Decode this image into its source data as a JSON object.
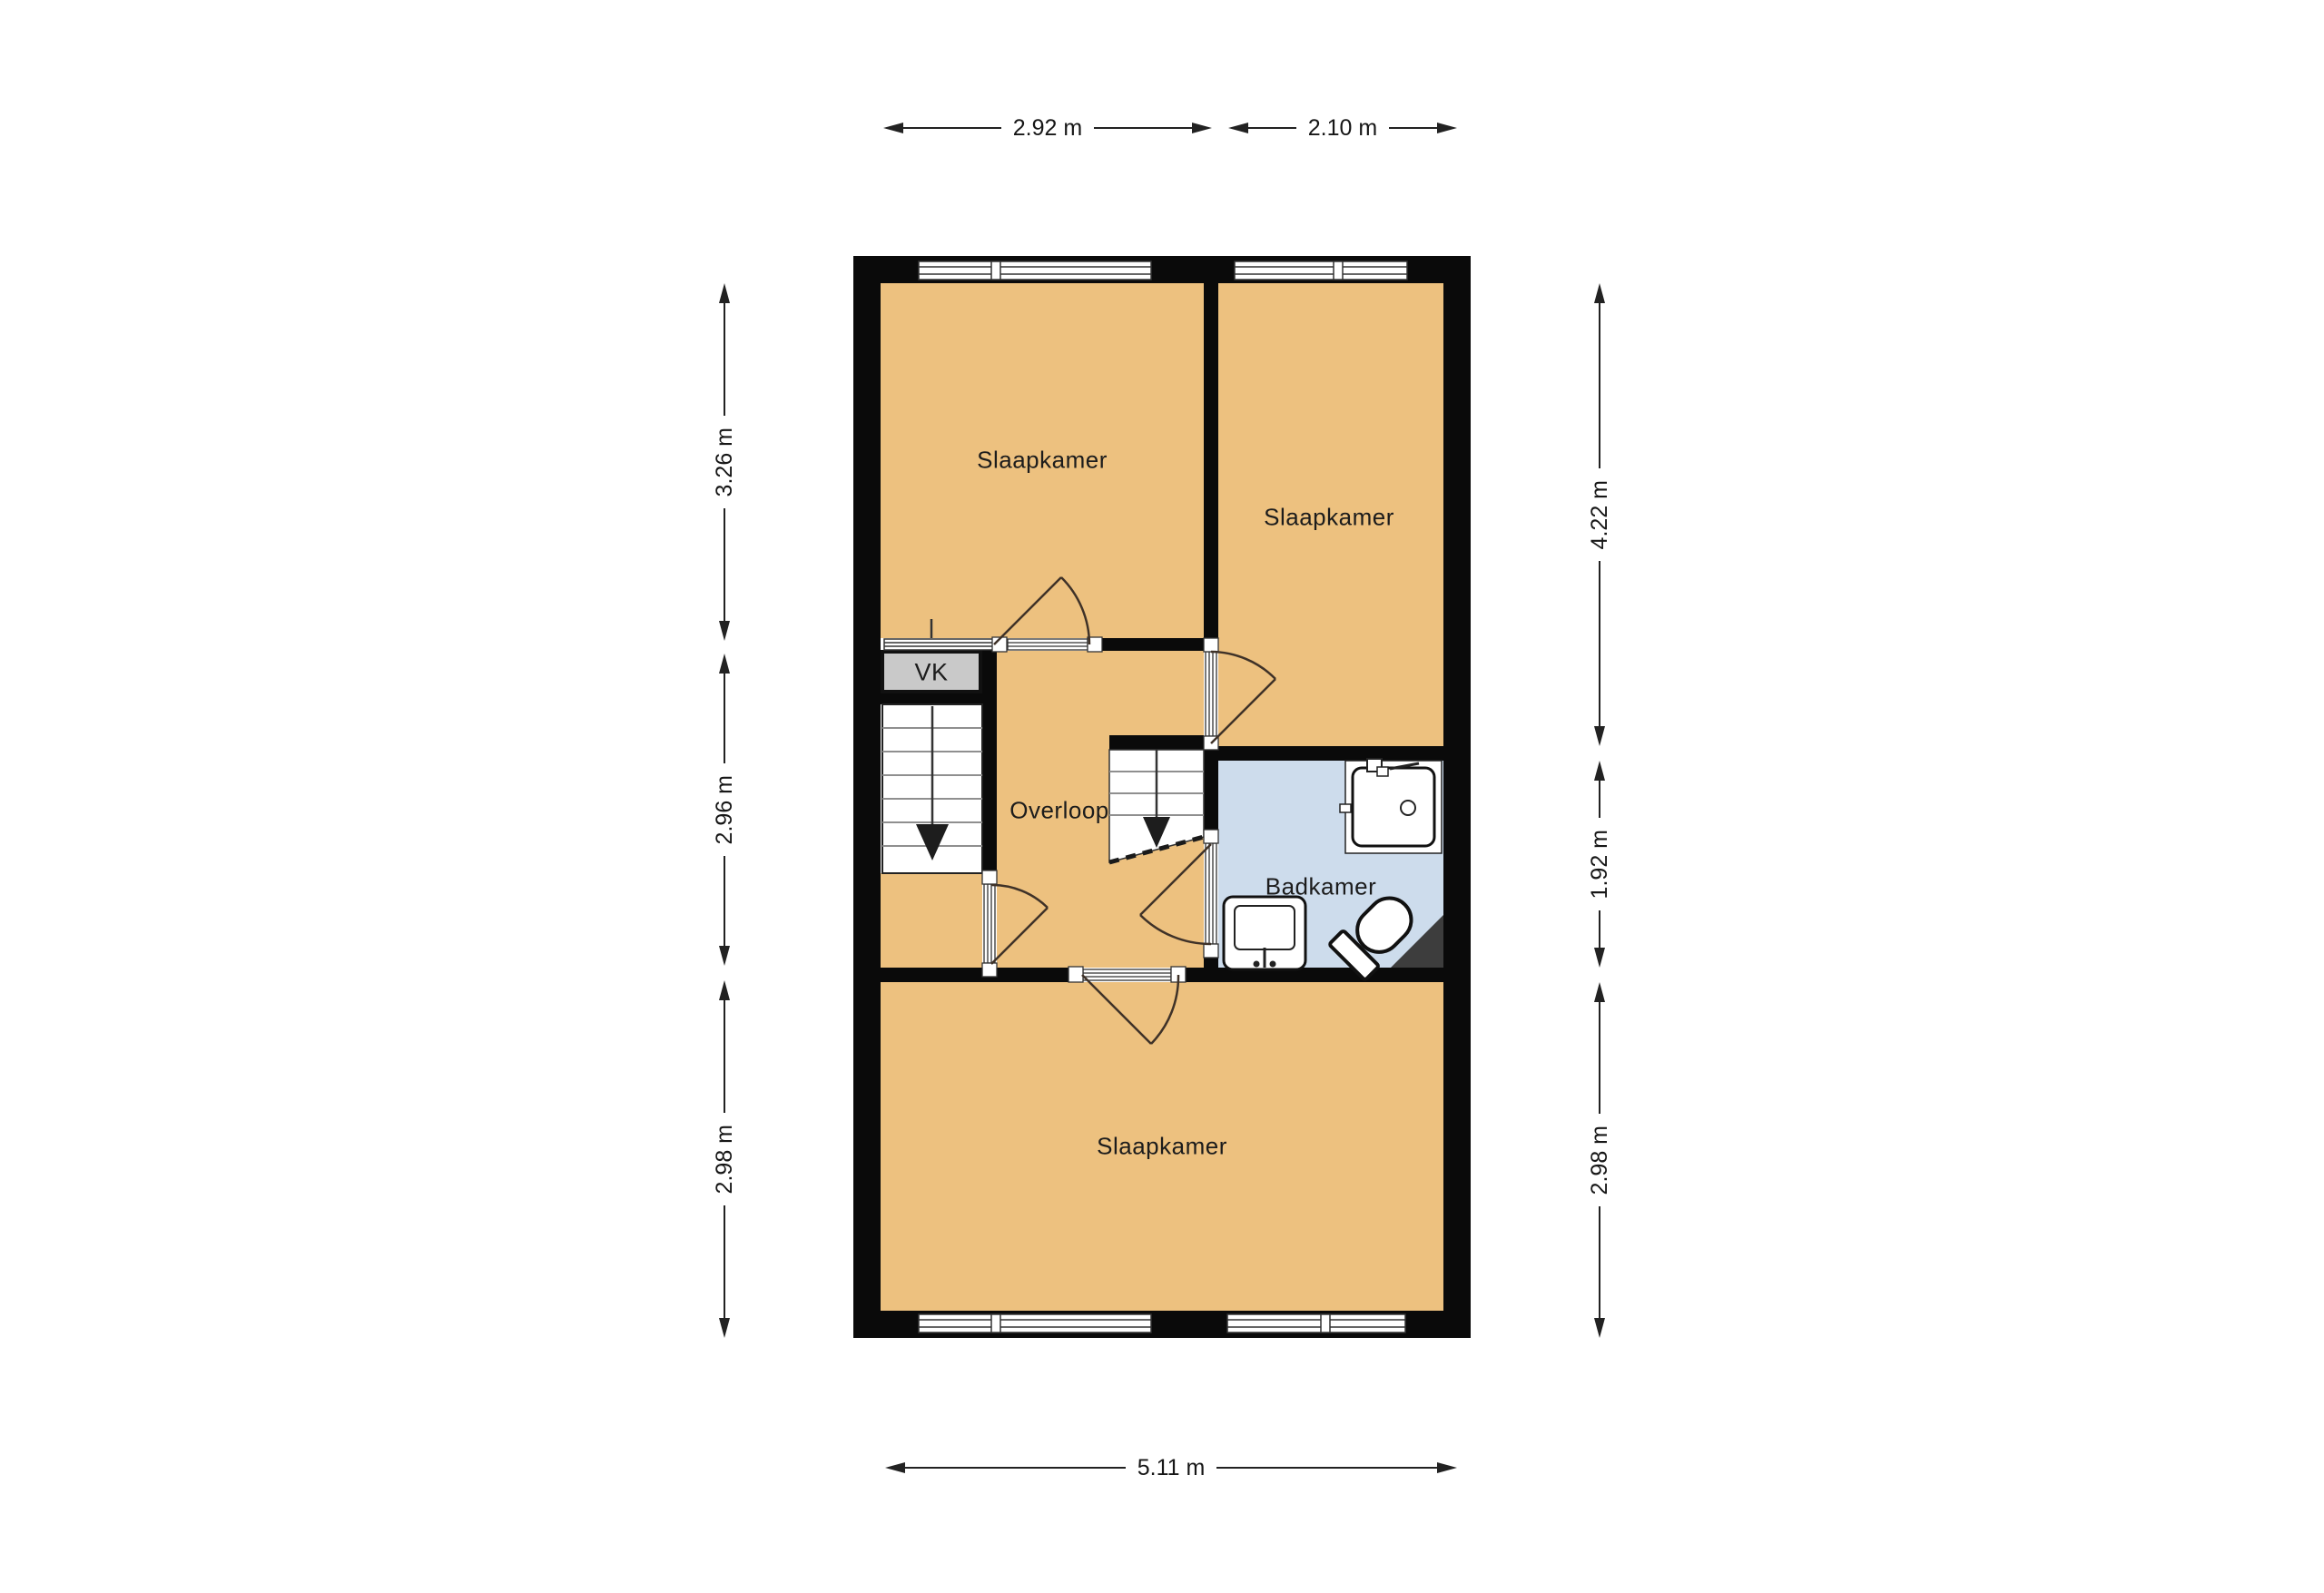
{
  "colors": {
    "canvas": "#ffffff",
    "room_fill": "#edc17f",
    "bathroom_fill": "#cddcec",
    "closet_fill": "#c9c9c9",
    "wall": "#0a0a0a"
  },
  "rooms": {
    "bedroom_top_left": {
      "label": "Slaapkamer"
    },
    "bedroom_top_right": {
      "label": "Slaapkamer"
    },
    "bedroom_bottom": {
      "label": "Slaapkamer"
    },
    "landing": {
      "label": "Overloop"
    },
    "bathroom": {
      "label": "Badkamer"
    },
    "closet": {
      "label": "VK"
    }
  },
  "dimensions": {
    "top": [
      {
        "label": "2.92 m"
      },
      {
        "label": "2.10 m"
      }
    ],
    "left": [
      {
        "label": "3.26 m"
      },
      {
        "label": "2.96 m"
      },
      {
        "label": "2.98 m"
      }
    ],
    "right": [
      {
        "label": "4.22 m"
      },
      {
        "label": "1.92 m"
      },
      {
        "label": "2.98 m"
      }
    ],
    "bottom": [
      {
        "label": "5.11 m"
      }
    ]
  }
}
